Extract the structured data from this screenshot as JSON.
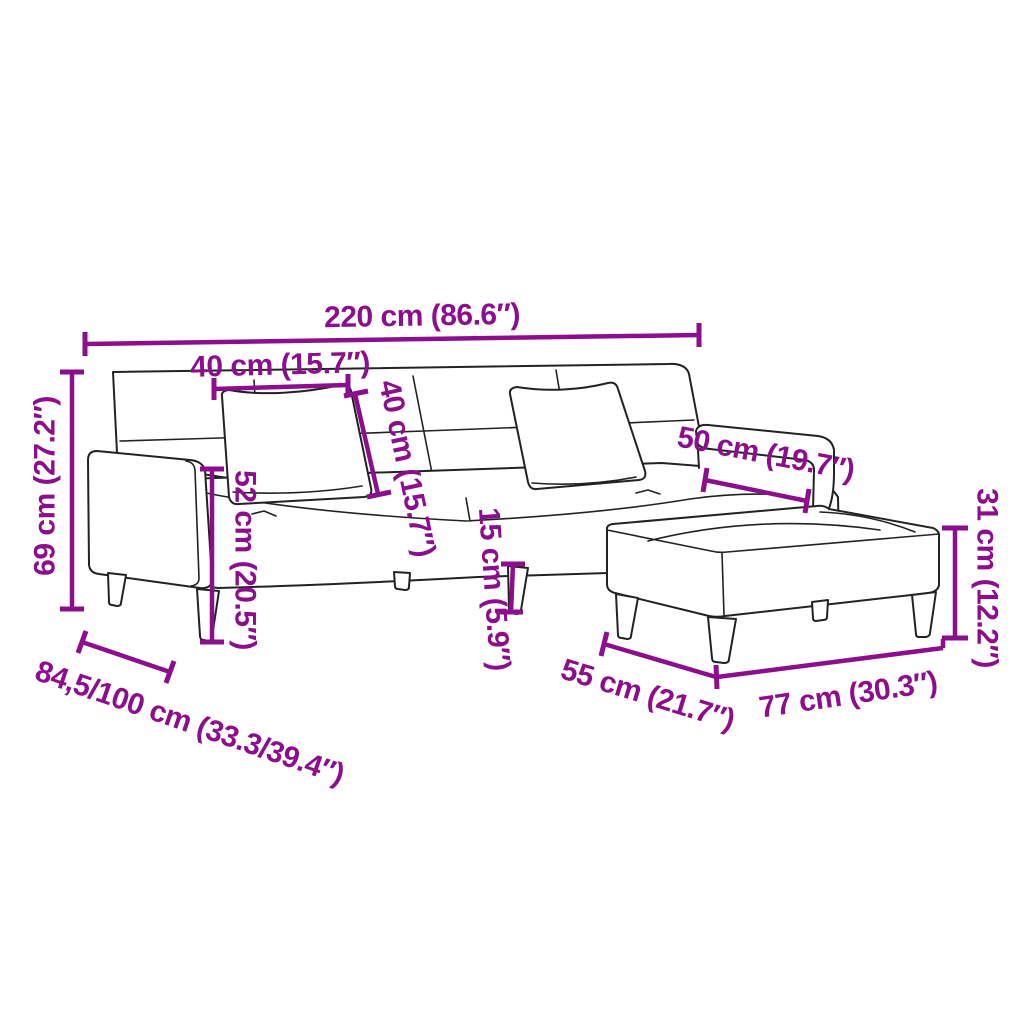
{
  "colors": {
    "accent": "#8D0E8D",
    "line": "#222222",
    "background": "#FFFFFF"
  },
  "dimensions": {
    "overall_width": "220 cm (86.6″)",
    "cushion_width": "40 cm (15.7″)",
    "cushion_height": "40 cm (15.7″)",
    "back_height": "69 cm (27.2″)",
    "seat_height": "52 cm (20.5″)",
    "leg_height": "15 cm (5.9″)",
    "armrest_length": "50 cm (19.7″)",
    "depth_range": "84,5/100 cm (33.3/39.4″)",
    "footstool_depth": "55 cm (21.7″)",
    "footstool_width": "77 cm (30.3″)",
    "footstool_height": "31 cm (12.2″)"
  }
}
